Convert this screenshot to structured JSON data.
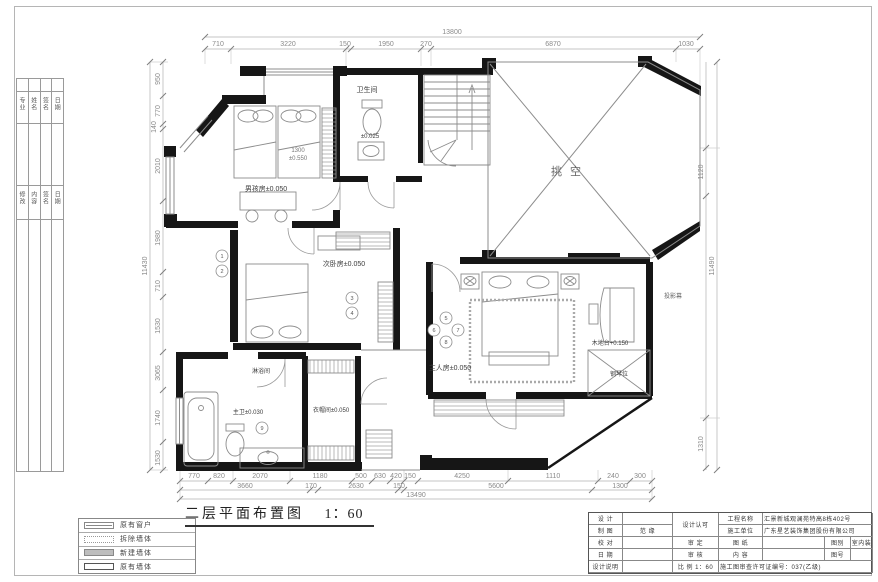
{
  "sheet": {
    "plan_title": "二层平面布置图",
    "plan_scale": "1：60"
  },
  "frame_strip": {
    "group1": [
      "专业",
      "姓名",
      "签名",
      "日期"
    ],
    "group2": [
      "修改",
      "内容",
      "签名",
      "日期"
    ]
  },
  "legend": {
    "items": [
      {
        "label": "原有窗户"
      },
      {
        "label": "拆除墙体"
      },
      {
        "label": "新建墙体"
      },
      {
        "label": "原有墙体"
      }
    ]
  },
  "labels": {
    "boy_room": "男孩房±0.050",
    "small_bath": "卫生间",
    "small_bath_level": "±0.025",
    "void": "挑空",
    "second_room": "次卧房±0.050",
    "master_room": "主人房±0.050",
    "platform": "木地台+0.150",
    "piano": "钢琴位",
    "projector": "投影幕",
    "shower": "淋浴间",
    "master_bath": "主卫±0.030",
    "closet": "衣帽间±0.050",
    "bed_width": "1300",
    "bed_level": "±0.550"
  },
  "callouts": [
    "1",
    "2",
    "3",
    "4",
    "5",
    "6",
    "7",
    "8",
    "9"
  ],
  "dims": {
    "top": {
      "overall": "13800",
      "segments": [
        "710",
        "3220",
        "150",
        "1950",
        "270",
        "6870",
        "1030"
      ]
    },
    "bottom": {
      "row1": [
        "770",
        "820",
        "2070",
        "1180",
        "500",
        "630",
        "420",
        "150",
        "4250",
        "1110",
        "240",
        "300"
      ],
      "row2": [
        "3660",
        "170",
        "2630",
        "150",
        "5600",
        "1300"
      ],
      "overall": "13490"
    },
    "left": {
      "overall": "11430",
      "segments": [
        "950",
        "770",
        "140",
        "2010",
        "1980",
        "710",
        "1530",
        "3065",
        "1740",
        "1530"
      ]
    },
    "right": {
      "overall": "11490",
      "segments": [
        "1120",
        "1310"
      ]
    }
  },
  "titleblock": {
    "design": "设 计",
    "draft": "制 图",
    "draft_value": "范 缘",
    "check": "校 对",
    "date": "日 期",
    "notes": "设计说明",
    "approval": "设计认可",
    "examine": "审 定",
    "review": "审 核",
    "scale_label": "比 例",
    "scale_value": "1：60",
    "project_label": "工程名称",
    "project_value": "汇景新城观澜苑特高8栋402号",
    "builder_label": "施工单位",
    "builder_value": "广东星艺装饰集团股份有限公司",
    "sheet_label": "图 纸",
    "content_label": "内 容",
    "category_label": "图别",
    "category_value": "室内装",
    "number_label": "图号",
    "permit": "施工图审查许可证编号：037(乙级)"
  }
}
